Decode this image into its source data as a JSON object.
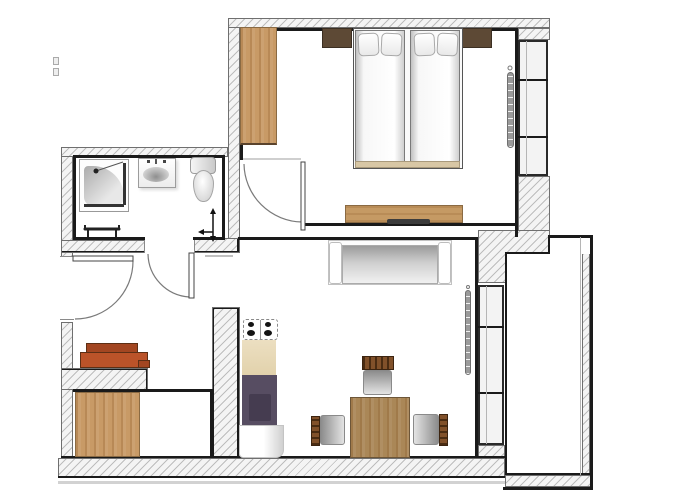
{
  "meta": {
    "type": "architectural-floor-plan",
    "view": "top-down",
    "width_px": 700,
    "height_px": 500,
    "text_labels": []
  },
  "palette": {
    "wall-hatch-bg": "#f4f4f4",
    "wall-hatch-line": "#bdbdbd",
    "wall-outline": "#6f6f6f",
    "bold-line": "#1a1a1a",
    "wood-light": "#c89a66",
    "wood-mid": "#c59a64",
    "wood-table": "#aa8757",
    "wood-dark": "#5d4935",
    "chair-wood": "#81512a",
    "shelf-orange": "#bb5329",
    "shelf-orange-dark": "#a34621",
    "kitchen-counter": "#ecdfc1",
    "kitchen-purple": "#574d62",
    "kitchen-purple-dark": "#453c50",
    "window-fill": "#f3f3f3",
    "metal-gray": "#9a9a9a",
    "seat-gray": "#8f8f8f",
    "floor-white": "#ffffff"
  },
  "rooms": [
    {
      "name": "bathroom",
      "fixtures": [
        "shower-cabin",
        "washbasin",
        "toilet",
        "towel-radiator",
        "valve-symbol"
      ]
    },
    {
      "name": "hallway",
      "features": [
        "entrance-door",
        "bathroom-door",
        "shoe-shelf-orange",
        "open-passage-to-living-room"
      ]
    },
    {
      "name": "storage-room",
      "furniture": [
        "wardrobe-wood"
      ]
    },
    {
      "name": "bedroom",
      "furniture": [
        "wardrobe-wood",
        "nightstand-left",
        "nightstand-right",
        "double-bed-two-mattresses-four-pillows",
        "sideboard-with-tv",
        "wall-radiator",
        "window-three-panes",
        "entry-door"
      ]
    },
    {
      "name": "living-dining-room",
      "furniture": [
        "sofa",
        "wall-radiator",
        "dining-table",
        "chair-north",
        "chair-west",
        "chair-east",
        "window-three-panes"
      ]
    },
    {
      "name": "kitchenette",
      "furniture": [
        "stove-four-burners",
        "counter-beige",
        "purple-unit-with-sink",
        "white-fridge-unit"
      ]
    },
    {
      "name": "balcony",
      "features": [
        "balcony-floor",
        "parapet-hatched-walls"
      ]
    }
  ]
}
